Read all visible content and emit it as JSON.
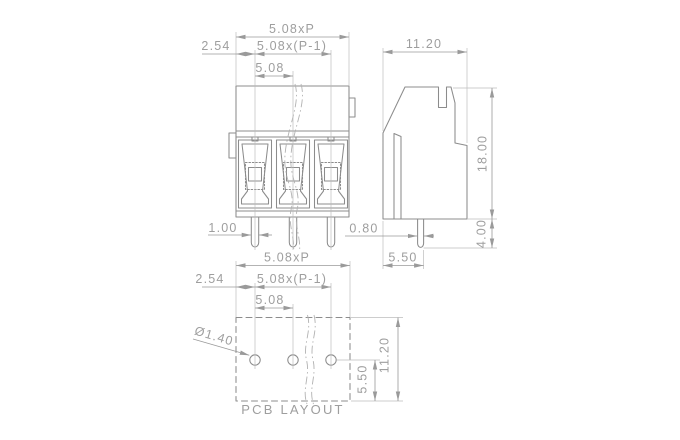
{
  "drawing": {
    "colors": {
      "background": "#ffffff",
      "outline": "#8c8c8c",
      "thin_line": "#bdbdbd",
      "text": "#9e9e9e"
    },
    "front_view": {
      "dim_total_width": "5.08xP",
      "dim_edge_to_pin": "2.54",
      "dim_pin_span": "5.08x(P-1)",
      "dim_pitch": "5.08",
      "dim_pin_width": "1.00"
    },
    "side_view": {
      "dim_body_width": "11.20",
      "dim_body_height": "18.00",
      "dim_pin_length": "4.00",
      "dim_pin_offset": "5.50",
      "dim_pin_thickness": "0.80"
    },
    "pcb_layout": {
      "dim_total_width": "5.08xP",
      "dim_edge_to_hole": "2.54",
      "dim_hole_span": "5.08x(P-1)",
      "dim_pitch": "5.08",
      "dim_hole_diameter": "Ø1.40",
      "dim_outline_height": "11.20",
      "dim_hole_offset": "5.50",
      "caption": "PCB LAYOUT"
    }
  }
}
